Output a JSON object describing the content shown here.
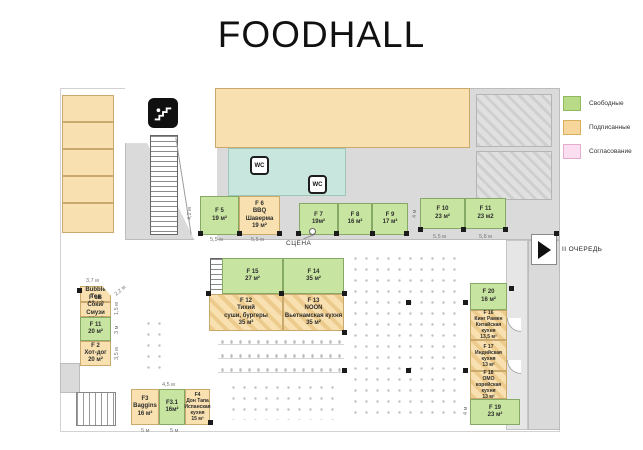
{
  "title": "FOODHALL",
  "legend": {
    "items": [
      {
        "label": "Свободные",
        "color": "#b9db88",
        "border": "#8fba5e"
      },
      {
        "label": "Подписанные",
        "color": "#f6d69b",
        "border": "#d9ae5f"
      },
      {
        "label": "Согласование",
        "color": "#fbdff0",
        "border": "#e3accf"
      }
    ]
  },
  "labels": {
    "stage": "СЦЕНА",
    "phase2": "II ОЧЕРЕДЬ",
    "wc": "WC"
  },
  "stalls": {
    "f1a": {
      "text": "F 1A\nBubble Tea\n10 м²",
      "status": "signed"
    },
    "f1b": {
      "text": "F 1B\nСоки/Смузи\n10 м²",
      "status": "signed"
    },
    "f1": {
      "text": "F 11\n20 м²",
      "status": "free"
    },
    "f2": {
      "text": "F 2\nХот-дог\n20 м²",
      "status": "signed"
    },
    "f3": {
      "text": "F3\nBaggins\n16 м²",
      "status": "signed"
    },
    "f31": {
      "text": "F3.1\n16м²",
      "status": "free"
    },
    "f4": {
      "text": "F4\nДон Тапа\nИспанская\nкухня\n15 м²",
      "status": "signed"
    },
    "f5": {
      "text": "F 5\n19 м²",
      "status": "free"
    },
    "f6": {
      "text": "F 6\nBBQ\nШаверма\n19 м²",
      "status": "signed"
    },
    "f7": {
      "text": "F 7\n19м²",
      "status": "free"
    },
    "f8": {
      "text": "F 8\n16 м²",
      "status": "free"
    },
    "f9": {
      "text": "F 9\n17 м²",
      "status": "free"
    },
    "f10": {
      "text": "F 10\n23 м²",
      "status": "free"
    },
    "f11": {
      "text": "F 11\n23 м2",
      "status": "free"
    },
    "f12": {
      "text": "F 12\nТихий\nсуши, бургеры\n35 м²",
      "status": "signed"
    },
    "f13": {
      "text": "F 13\nNOON\nВьетнамская кухня\n35 м²",
      "status": "signed"
    },
    "f14": {
      "text": "F 14\n35 м²",
      "status": "free"
    },
    "f15": {
      "text": "F 15\n27 м²",
      "status": "free"
    },
    "f16": {
      "text": "F 16\nКинг Рамен\nКитайская\nкухня\n13,5 м²",
      "status": "signed"
    },
    "f17": {
      "text": "F 17\nИндийская\nкухня\n13 м²",
      "status": "signed"
    },
    "f18": {
      "text": "F 18\nOMO\nкорейская\nкухня\n13 м²",
      "status": "signed"
    },
    "f19": {
      "text": "F 19\n23 м²",
      "status": "free"
    },
    "f20": {
      "text": "F 20\n16 м²",
      "status": "free"
    }
  },
  "dims": {
    "d42": "4,2 м",
    "d55a": "5,5 м",
    "d55b": "5,5 м",
    "d55c": "5,5 м",
    "d58": "5,8 м",
    "d4a": "4 м",
    "d37": "3,7 м",
    "d22": "2,2 м",
    "d15": "1,5 м",
    "d3": "3 м",
    "d35": "3,5 м",
    "d45": "4,5 м",
    "d5a": "5 м",
    "d5b": "5 м",
    "d4b": "4 м"
  }
}
